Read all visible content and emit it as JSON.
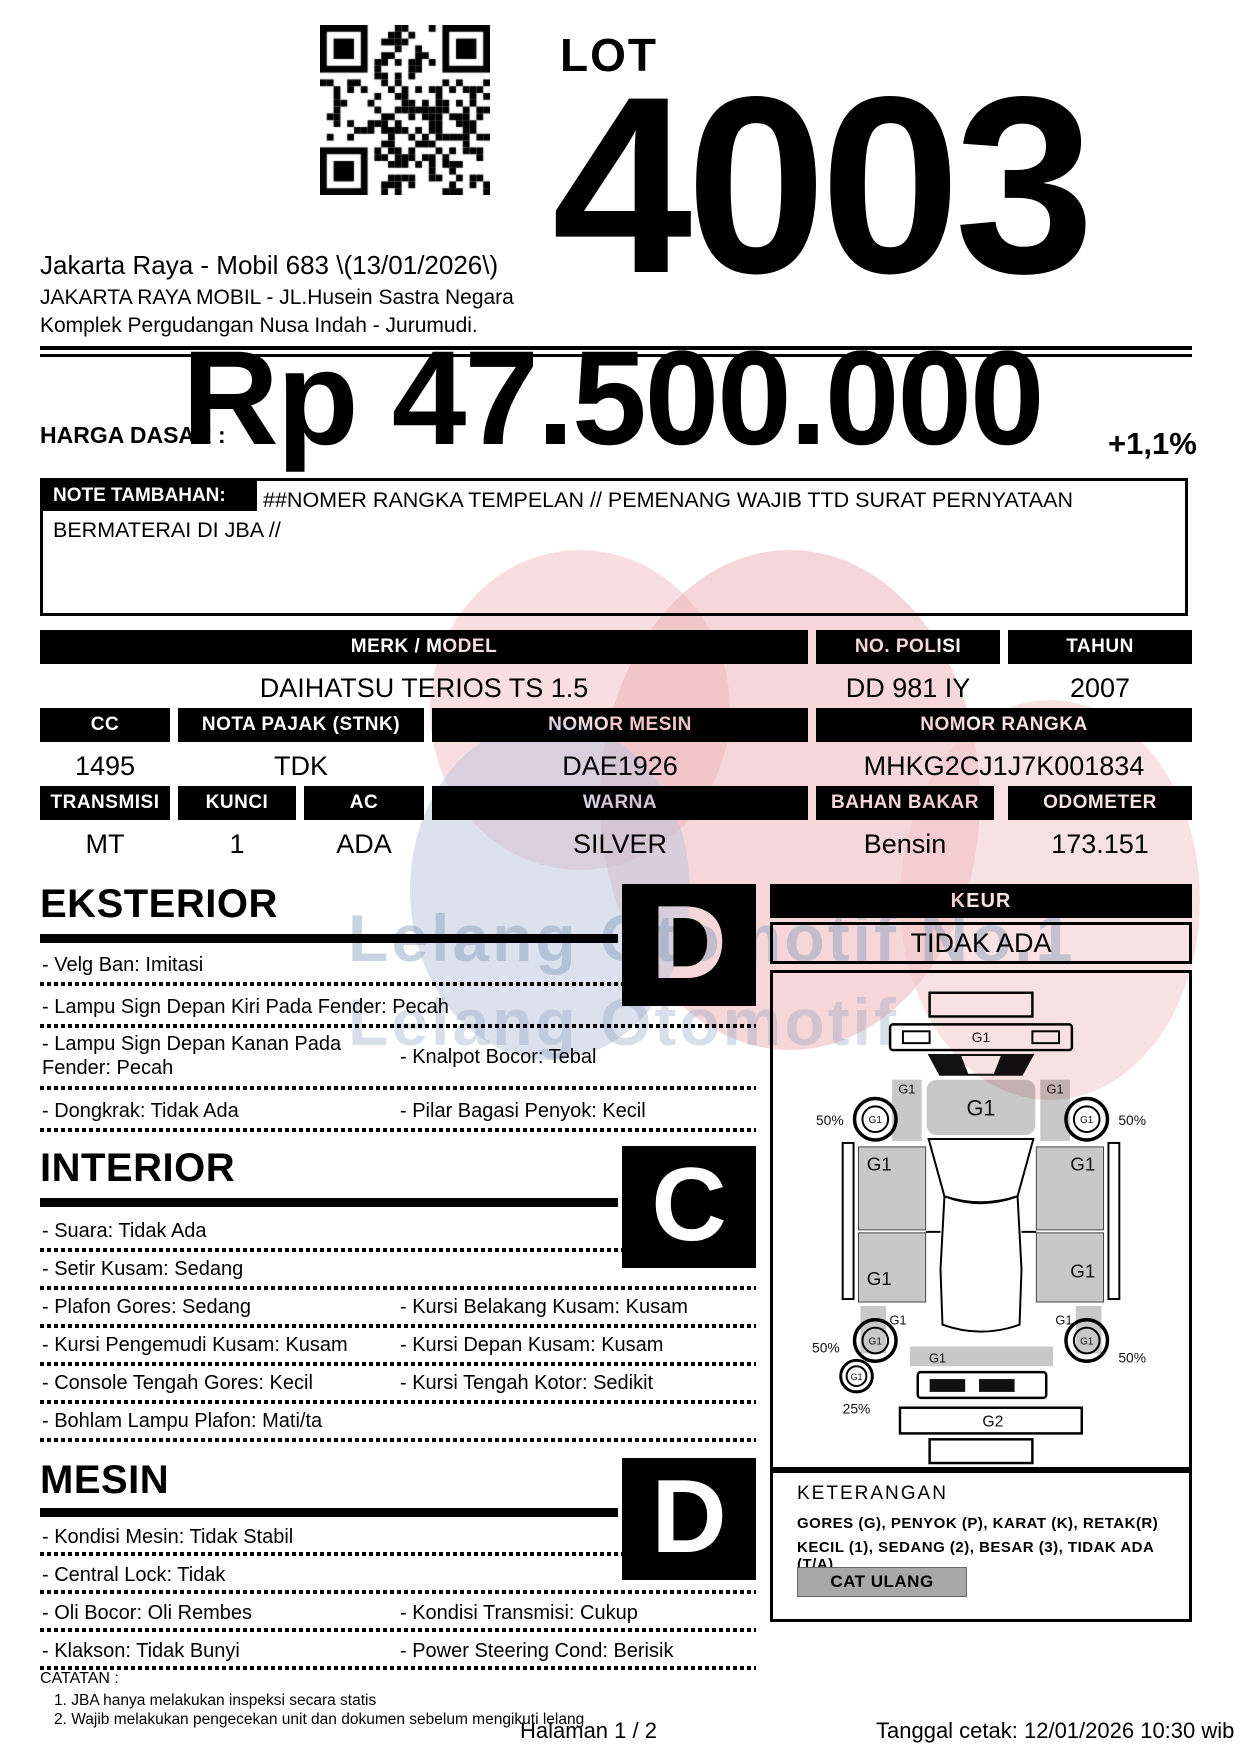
{
  "header": {
    "lot_label": "LOT",
    "lot_number": "4003",
    "auction_title": "Jakarta Raya - Mobil 683 \\(13/01/2026\\)",
    "address_line1": "JAKARTA RAYA MOBIL - JL.Husein Sastra Negara",
    "address_line2": "Komplek Pergudangan Nusa Indah - Jurumudi."
  },
  "price": {
    "label": "HARGA DASAR :",
    "amount": "Rp 47.500.000",
    "increment": "+1,1%"
  },
  "note": {
    "label": "NOTE TAMBAHAN:",
    "text": "##NOMER RANGKA TEMPELAN // PEMENANG WAJIB TTD SURAT PERNYATAAN BERMATERAI DI JBA //"
  },
  "vehicle": {
    "merk_model": {
      "label": "MERK / MODEL",
      "value": "DAIHATSU TERIOS TS 1.5"
    },
    "no_polisi": {
      "label": "NO. POLISI",
      "value": "DD 981 IY"
    },
    "tahun": {
      "label": "TAHUN",
      "value": "2007"
    },
    "cc": {
      "label": "CC",
      "value": "1495"
    },
    "nota_pajak": {
      "label": "NOTA PAJAK (STNK)",
      "value": "TDK"
    },
    "nomor_mesin": {
      "label": "NOMOR MESIN",
      "value": "DAE1926"
    },
    "nomor_rangka": {
      "label": "NOMOR RANGKA",
      "value": "MHKG2CJ1J7K001834"
    },
    "transmisi": {
      "label": "TRANSMISI",
      "value": "MT"
    },
    "kunci": {
      "label": "KUNCI",
      "value": "1"
    },
    "ac": {
      "label": "AC",
      "value": "ADA"
    },
    "warna": {
      "label": "WARNA",
      "value": "SILVER"
    },
    "bahan_bakar": {
      "label": "BAHAN BAKAR",
      "value": "Bensin"
    },
    "odometer": {
      "label": "ODOMETER",
      "value": "173.151"
    }
  },
  "sections": {
    "eksterior": {
      "title": "EKSTERIOR",
      "grade": "D",
      "rows": [
        {
          "left": "- Velg Ban: Imitasi"
        },
        {
          "left": "- Lampu Sign Depan Kiri Pada Fender: Pecah"
        },
        {
          "left": "- Lampu Sign Depan Kanan Pada Fender: Pecah",
          "right": "- Knalpot Bocor: Tebal"
        },
        {
          "left": "- Dongkrak: Tidak Ada",
          "right": "- Pilar Bagasi Penyok: Kecil"
        }
      ]
    },
    "interior": {
      "title": "INTERIOR",
      "grade": "C",
      "rows": [
        {
          "left": "- Suara: Tidak Ada"
        },
        {
          "left": "- Setir Kusam: Sedang"
        },
        {
          "left": "- Plafon Gores: Sedang",
          "right": "- Kursi Belakang Kusam: Kusam"
        },
        {
          "left": "- Kursi Pengemudi Kusam: Kusam",
          "right": "- Kursi Depan Kusam: Kusam"
        },
        {
          "left": "- Console Tengah Gores: Kecil",
          "right": "- Kursi Tengah Kotor: Sedikit"
        },
        {
          "left": "- Bohlam Lampu Plafon: Mati/ta"
        }
      ]
    },
    "mesin": {
      "title": "MESIN",
      "grade": "D",
      "rows": [
        {
          "left": "- Kondisi Mesin: Tidak Stabil"
        },
        {
          "left": "- Central Lock: Tidak"
        },
        {
          "left": "- Oli Bocor: Oli Rembes",
          "right": "- Kondisi Transmisi: Cukup"
        },
        {
          "left": "- Klakson: Tidak Bunyi",
          "right": "- Power Steering Cond: Berisik"
        }
      ]
    }
  },
  "keur": {
    "label": "KEUR",
    "value": "TIDAK ADA"
  },
  "diagram": {
    "g1": "G1",
    "g2": "G2",
    "pct_front_left": "50%",
    "pct_front_right": "50%",
    "pct_rear_left": "50%",
    "pct_rear_right": "50%",
    "pct_spare": "25%"
  },
  "keterangan": {
    "title": "KETERANGAN",
    "line1": "GORES (G), PENYOK (P), KARAT (K), RETAK(R)",
    "line2": "KECIL (1), SEDANG (2), BESAR (3), TIDAK ADA (T/A)",
    "chip": "CAT ULANG"
  },
  "catatan": {
    "title": "CATATAN :",
    "item1": "1. JBA hanya melakukan inspeksi secara statis",
    "item2": "2. Wajib melakukan pengecekan unit dan dokumen sebelum mengikuti lelang"
  },
  "footer": {
    "page": "Halaman 1 / 2",
    "printed": "Tanggal cetak: 12/01/2026 10:30 wib"
  },
  "watermark": {
    "line1": "Lelang Otomotif No.1",
    "line2": "Lelang Otomotif",
    "colors": {
      "pink": "#f2c3c6",
      "red": "#edb0b3",
      "blue": "#b9c3de",
      "text": "#7d96b9"
    }
  }
}
